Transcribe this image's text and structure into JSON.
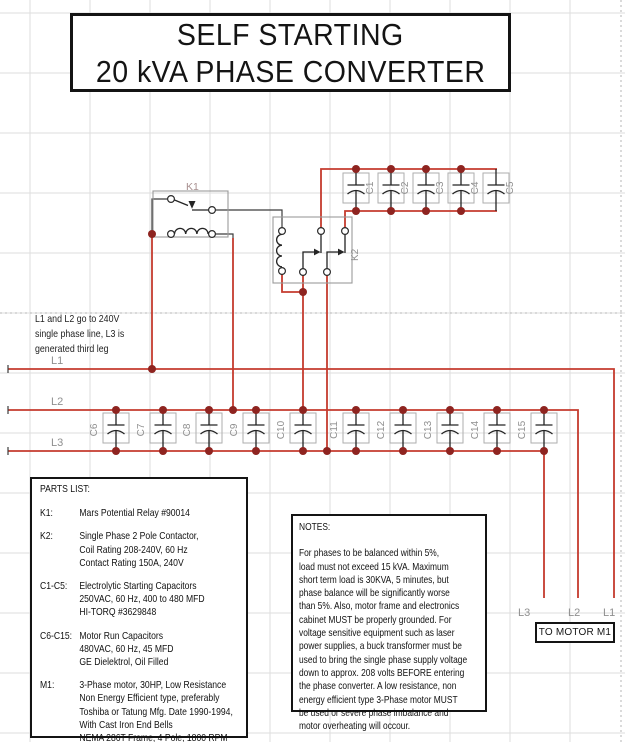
{
  "title": {
    "line1": "SELF STARTING",
    "line2": "20 kVA PHASE CONVERTER"
  },
  "side_note": {
    "lines": [
      "L1 and L2 go to 240V",
      "single phase line, L3 is",
      "generated third leg"
    ]
  },
  "schematic": {
    "relay_label": "K1",
    "contactor_label": "K2",
    "start_caps": [
      "C1",
      "C2",
      "C3",
      "C4",
      "C5"
    ],
    "run_caps": [
      "C6",
      "C7",
      "C8",
      "C9",
      "C10",
      "C11",
      "C12",
      "C13",
      "C14",
      "C15"
    ],
    "phase_lines": [
      "L1",
      "L2",
      "L3"
    ],
    "motor_feed_labels": [
      "L3",
      "L2",
      "L1"
    ],
    "motor_box_label": "TO MOTOR M1"
  },
  "parts_list": {
    "title": "PARTS LIST:",
    "items": [
      {
        "ref": "K1:",
        "lines": [
          "Mars Potential Relay #90014"
        ]
      },
      {
        "ref": "K2:",
        "lines": [
          "Single Phase 2 Pole Contactor,",
          "Coil Rating 208-240V, 60 Hz",
          "Contact Rating 150A, 240V"
        ]
      },
      {
        "ref": "C1-C5:",
        "lines": [
          "Electrolytic Starting Capacitors",
          "250VAC, 60 Hz, 400 to 480 MFD",
          "HI-TORQ #3629848"
        ]
      },
      {
        "ref": "C6-C15:",
        "lines": [
          "Motor Run Capacitors",
          "480VAC, 60 Hz, 45 MFD",
          "GE Dielektrol, Oil Filled"
        ]
      },
      {
        "ref": "M1:",
        "lines": [
          "3-Phase motor, 30HP, Low Resistance",
          "Non Energy Efficient type, preferably",
          "Toshiba or Tatung Mfg. Date 1990-1994,",
          "With Cast Iron End Bells",
          "NEMA 286T Frame, 4 Pole, 1800 RPM"
        ]
      }
    ]
  },
  "notes": {
    "title": "NOTES:",
    "lines": [
      "For phases to be balanced within 5%,",
      "load must not exceed 15 kVA.  Maximum",
      "short term load is 30KVA, 5 minutes, but",
      "phase balance will be significantly worse",
      "than 5%.  Also, motor frame and electronics",
      "cabinet MUST be properly grounded.  For",
      "voltage sensitive equipment such as laser",
      "power supplies, a buck transformer must be",
      "used to bring the single phase supply voltage",
      "down to approx. 208 volts BEFORE entering",
      "the phase converter.  A low resistance, non",
      "energy efficient type 3-Phase motor MUST",
      "be used or severe phase imbalance and",
      "motor overheating will occour."
    ]
  },
  "colors": {
    "wire_red": "#c53b2e",
    "junction_dot": "#8e2420",
    "component_gray": "#9a9a9a",
    "label_gray": "#8f8f8f",
    "grid": "#dedede"
  }
}
